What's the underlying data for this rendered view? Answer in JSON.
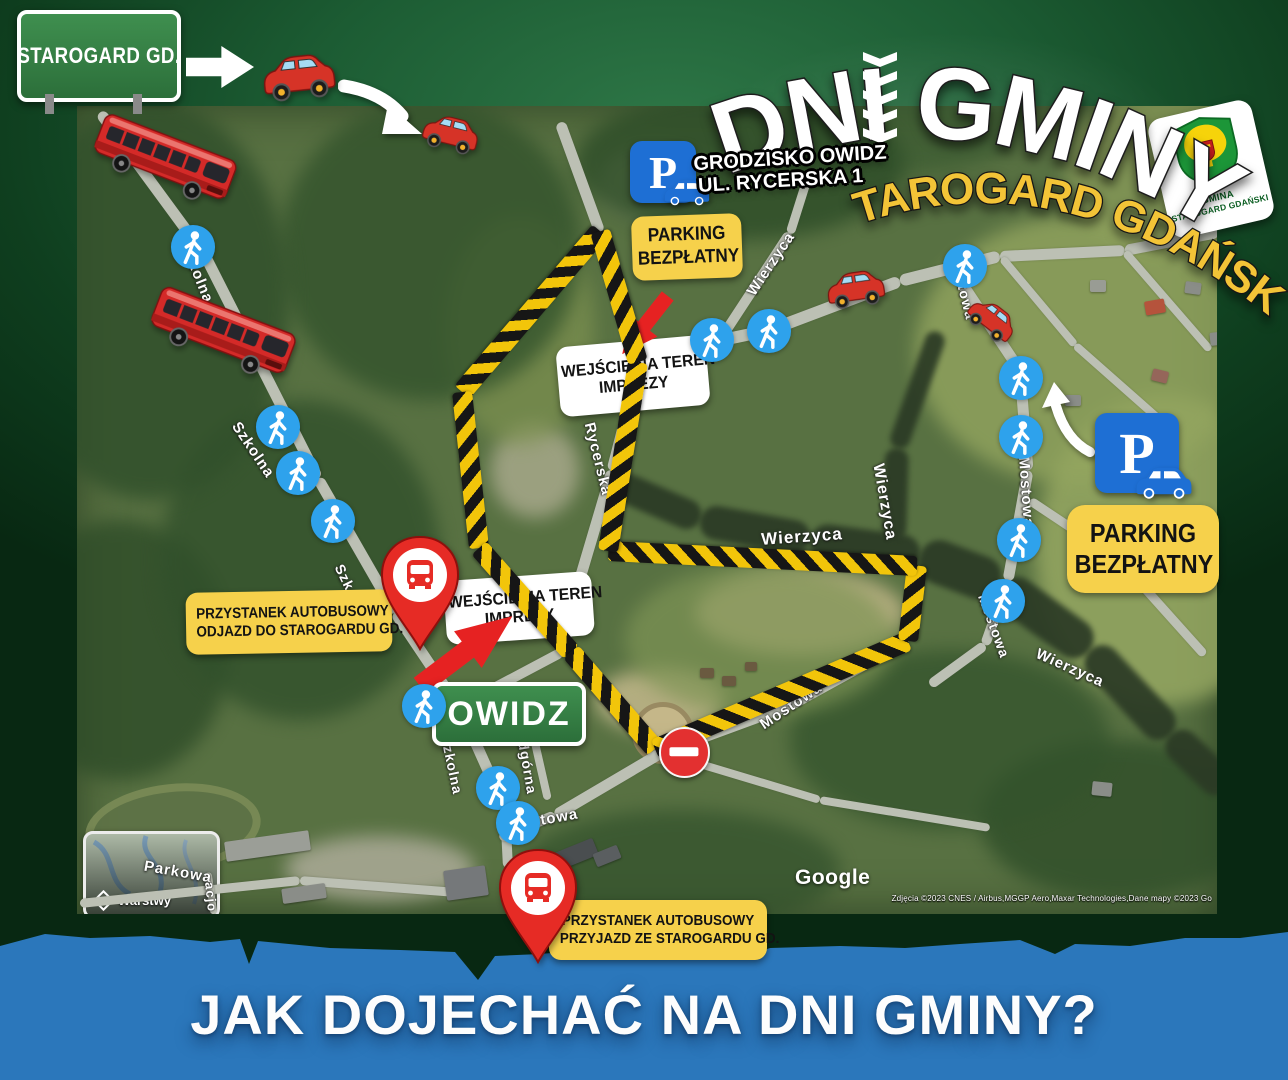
{
  "header": {
    "origin_sign": "STAROGARD GD.",
    "title": {
      "part1": "DNI",
      "part2": "GMINY",
      "combined": "DNI  GMINY"
    },
    "subtitle": "STAROGARD GDAŃSKI",
    "venue_line1": "GRODZISKO OWIDZ",
    "venue_line2": "UL. RYCERSKA 1",
    "logo": {
      "line1": "GMINA",
      "line2": "STAROGARD GDAŃSKI"
    }
  },
  "callouts": {
    "parking1": {
      "line1": "PARKING",
      "line2": "BEZPŁATNY"
    },
    "parking2": {
      "line1": "PARKING",
      "line2": "BEZPŁATNY"
    },
    "entrance1": {
      "line1": "WEJŚCIE NA TEREN",
      "line2": "IMPREZY"
    },
    "entrance2": {
      "line1": "WEJŚCIE NA TEREN",
      "line2": "IMPREZY"
    },
    "busDeparture": {
      "line1": "PRZYSTANEK AUTOBUSOWY",
      "line2": "ODJAZD DO STAROGARDU GD."
    },
    "busArrival": {
      "line1": "PRZYSTANEK AUTOBUSOWY",
      "line2": "PRZYJAZD ZE STAROGARDU GD."
    },
    "village_sign": "OWIDZ"
  },
  "map": {
    "google_logo": "Google",
    "attribution": "Zdjęcia ©2023 CNES / Airbus,MGGP Aero,Maxar Technologies,Dane mapy ©2023 Go",
    "layers_label": "Warstwy",
    "street_labels": [
      {
        "text": "Szkolna",
        "x": 197,
        "y": 273,
        "rot": 68,
        "size": 15
      },
      {
        "text": "Szkolna",
        "x": 253,
        "y": 450,
        "rot": 56,
        "size": 15
      },
      {
        "text": "Szkolna",
        "x": 352,
        "y": 592,
        "rot": 64,
        "size": 14
      },
      {
        "text": "Szkolna",
        "x": 452,
        "y": 765,
        "rot": 78,
        "size": 14
      },
      {
        "text": "Rycerska",
        "x": 598,
        "y": 459,
        "rot": 76,
        "size": 15
      },
      {
        "text": "Wierzyca",
        "x": 771,
        "y": 264,
        "rot": -56,
        "size": 15
      },
      {
        "text": "Wierzyca",
        "x": 802,
        "y": 537,
        "rot": -4,
        "size": 17
      },
      {
        "text": "Wierzyca",
        "x": 884,
        "y": 502,
        "rot": 80,
        "size": 16
      },
      {
        "text": "Wierzyca",
        "x": 1070,
        "y": 668,
        "rot": 24,
        "size": 15
      },
      {
        "text": "Mostowa",
        "x": 963,
        "y": 287,
        "rot": 76,
        "size": 14
      },
      {
        "text": "Mostowa",
        "x": 1026,
        "y": 492,
        "rot": 86,
        "size": 15
      },
      {
        "text": "Mostowa",
        "x": 994,
        "y": 626,
        "rot": 70,
        "size": 14
      },
      {
        "text": "Mostowa",
        "x": 791,
        "y": 706,
        "rot": -34,
        "size": 15
      },
      {
        "text": "Mostowa",
        "x": 543,
        "y": 820,
        "rot": -10,
        "size": 15
      },
      {
        "text": "Podgórna",
        "x": 526,
        "y": 758,
        "rot": 80,
        "size": 14
      },
      {
        "text": "Parkowa",
        "x": 178,
        "y": 872,
        "rot": 10,
        "size": 15
      },
      {
        "text": "acjo",
        "x": 211,
        "y": 897,
        "rot": 84,
        "size": 13
      }
    ],
    "walkers": [
      [
        193,
        247
      ],
      [
        278,
        427
      ],
      [
        298,
        473
      ],
      [
        333,
        521
      ],
      [
        424,
        706
      ],
      [
        712,
        340
      ],
      [
        769,
        331
      ],
      [
        965,
        266
      ],
      [
        1021,
        378
      ],
      [
        1021,
        437
      ],
      [
        1019,
        540
      ],
      [
        1003,
        601
      ],
      [
        498,
        788
      ],
      [
        518,
        823
      ]
    ],
    "cars": [
      [
        298,
        74,
        -6,
        80
      ],
      [
        450,
        131,
        14,
        62
      ],
      [
        855,
        287,
        -8,
        64
      ],
      [
        991,
        317,
        38,
        56
      ]
    ],
    "buses": [
      [
        165,
        161,
        21,
        148
      ],
      [
        223,
        334,
        21,
        150
      ]
    ],
    "route_stripes": [
      [
        600,
        231,
        462,
        392
      ],
      [
        462,
        392,
        479,
        548
      ],
      [
        479,
        548,
        571,
        652
      ],
      [
        571,
        652,
        655,
        749
      ],
      [
        655,
        749,
        908,
        641
      ],
      [
        908,
        641,
        917,
        566
      ],
      [
        917,
        566,
        608,
        551
      ],
      [
        608,
        551,
        638,
        362
      ],
      [
        638,
        362,
        600,
        231
      ]
    ],
    "bus_pins": [
      [
        378,
        535
      ],
      [
        496,
        848
      ]
    ],
    "no_entry": {
      "x": 682,
      "y": 750,
      "d": 47
    }
  },
  "footer": {
    "question": "JAK DOJECHAĆ NA DNI GMINY?"
  },
  "colors": {
    "accent_yellow": "#f6d14b",
    "band_blue": "#2b77bb",
    "sign_green": "#2f7a3e",
    "parking_blue": "#1e6fd4",
    "hazard_yellow": "#f2c50a",
    "marker_red": "#e6302a",
    "walker_blue": "#2ea2ec"
  }
}
